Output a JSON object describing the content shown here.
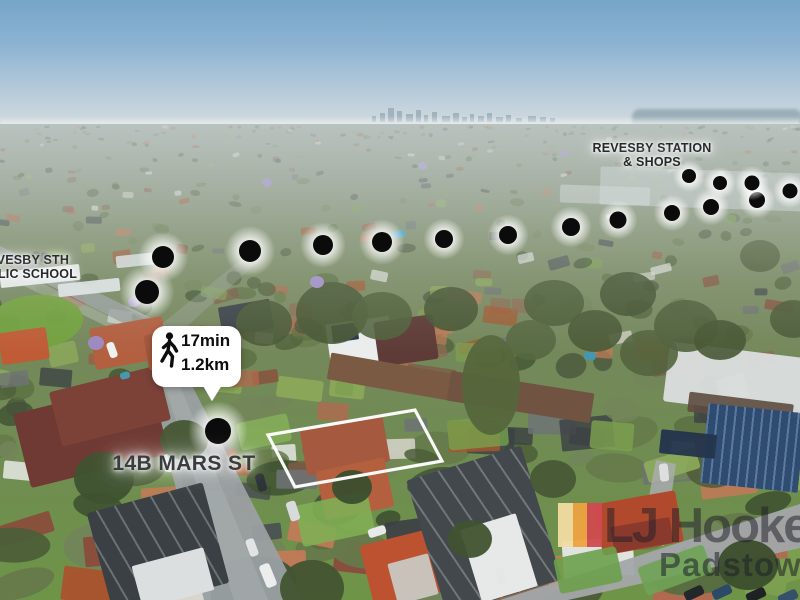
{
  "annotations": {
    "station_label": {
      "line1": "REVESBY STATION",
      "line2": "& SHOPS"
    },
    "school_label": {
      "line1": "REVESBY STH",
      "line2": "PUBLIC SCHOOL"
    },
    "walk_callout": {
      "time": "17min",
      "distance": "1.2km",
      "icon": "walking-person-icon"
    },
    "address_label": {
      "text": "14B MARS ST"
    },
    "route_dots": [
      {
        "x": 218,
        "y": 431,
        "r": 13
      },
      {
        "x": 147,
        "y": 292,
        "r": 12
      },
      {
        "x": 163,
        "y": 257,
        "r": 11
      },
      {
        "x": 250,
        "y": 251,
        "r": 11
      },
      {
        "x": 323,
        "y": 245,
        "r": 10
      },
      {
        "x": 382,
        "y": 242,
        "r": 10
      },
      {
        "x": 444,
        "y": 239,
        "r": 9
      },
      {
        "x": 508,
        "y": 235,
        "r": 9
      },
      {
        "x": 571,
        "y": 227,
        "r": 9
      },
      {
        "x": 618,
        "y": 220,
        "r": 8.5
      },
      {
        "x": 672,
        "y": 213,
        "r": 8
      },
      {
        "x": 711,
        "y": 207,
        "r": 8
      },
      {
        "x": 757,
        "y": 200,
        "r": 8
      },
      {
        "x": 790,
        "y": 191,
        "r": 7.5
      },
      {
        "x": 752,
        "y": 183,
        "r": 7.5
      },
      {
        "x": 720,
        "y": 183,
        "r": 7
      },
      {
        "x": 689,
        "y": 176,
        "r": 7
      }
    ],
    "property_boundary": {
      "stroke": "#ffffff",
      "points": [
        [
          268,
          435
        ],
        [
          415,
          410
        ],
        [
          442,
          461
        ],
        [
          295,
          487
        ]
      ]
    }
  },
  "watermark": {
    "brand": "LJ Hooker",
    "office": "Padstow",
    "stripe_colors": [
      "#F2DCA2",
      "#EFA341",
      "#D04B50"
    ]
  }
}
